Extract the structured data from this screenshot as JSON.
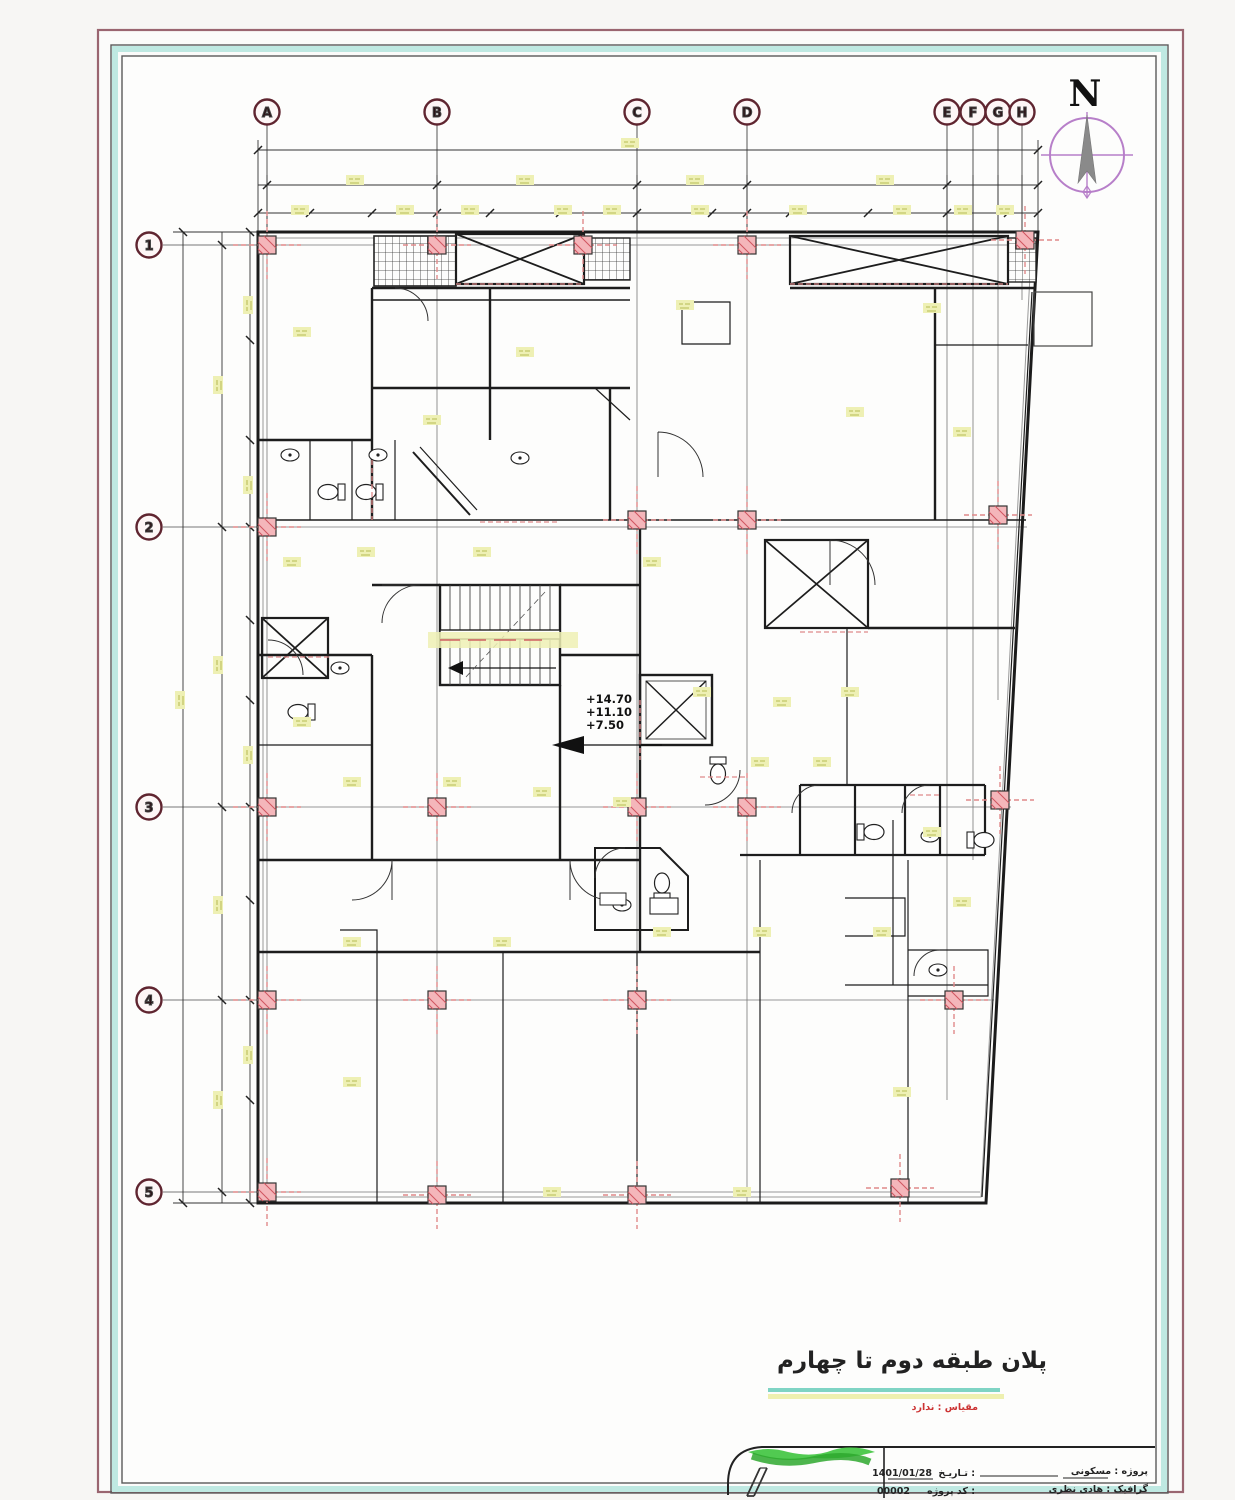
{
  "compass": {
    "label": "N"
  },
  "grid": {
    "cols": [
      "A",
      "B",
      "C",
      "D",
      "E",
      "F",
      "G",
      "H"
    ],
    "rows": [
      "1",
      "2",
      "3",
      "4",
      "5"
    ]
  },
  "levels": [
    "+14.70",
    "+11.10",
    "+7.50"
  ],
  "title": {
    "text": "پلان طبقه دوم تا چهارم",
    "scale_note": "مقیاس : ندارد"
  },
  "titleblock": {
    "project_line": "پروژه : مسکونی",
    "designer_line": "گرافیک : هادی نظری",
    "date_label": "تـاریـخ :",
    "date_value": "1401/01/28",
    "code_label": "کد پروژه :",
    "code_value": "00002"
  },
  "colors": {
    "border_maroon": "#9a6570",
    "border_teal": "#bfe9e2",
    "grid_bubble": "#5f2530",
    "column_fill": "#f4b6ba",
    "column_hatch": "#d05560",
    "axis_red": "#e08a8a",
    "dim_yellow": "#eef0b4",
    "compass_purple": "#b77fc9",
    "compass_gray": "#8a8a8a",
    "title_red": "#cc3333",
    "scribble_green": "#3ec43e"
  }
}
